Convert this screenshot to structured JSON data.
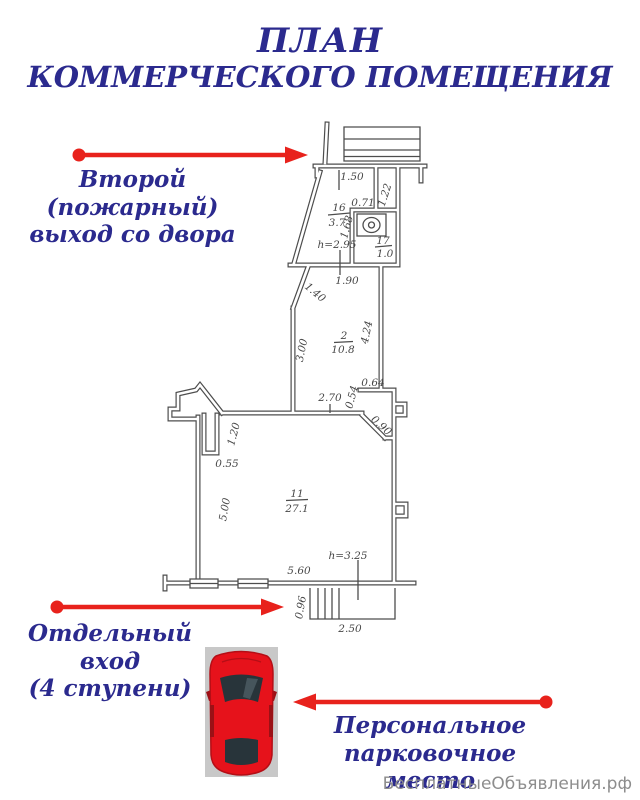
{
  "title": {
    "line1": "ПЛАН",
    "line2": "КОММЕРЧЕСКОГО ПОМЕЩЕНИЯ"
  },
  "annotations": {
    "fire_exit_line1": "Второй (пожарный)",
    "fire_exit_line2": "выход со двора",
    "entrance_line1": "Отдельный вход",
    "entrance_line2": "(4 ступени)",
    "parking_line1": "Персональное",
    "parking_line2": "парковочное место"
  },
  "watermark": "БесплатныеОбъявления.рф",
  "plan": {
    "rooms": {
      "r16": {
        "num": "16",
        "area": "3.7"
      },
      "r17": {
        "num": "17",
        "area": "1.0"
      },
      "r2": {
        "num": "2",
        "area": "10.8"
      },
      "r11": {
        "num": "11",
        "area": "27.1"
      }
    },
    "dims": {
      "d150": "1.50",
      "d122": "1.22",
      "d071": "0.71",
      "d168": "1.68",
      "h295": "h=2.95",
      "d190": "1.90",
      "d140": "1.40",
      "d300": "3.00",
      "d424": "4.24",
      "d270": "2.70",
      "d064": "0.64",
      "d054": "0.54",
      "d090": "0.90",
      "d120": "1.20",
      "d055": "0.55",
      "d500": "5.00",
      "d560": "5.60",
      "h325": "h=3.25",
      "d096": "0.96",
      "d250": "2.50"
    }
  },
  "colors": {
    "heading_blue": "#2b2a8e",
    "arrow_red": "#e8221c",
    "plan_line": "#4d4d4d",
    "car_red": "#e6121b",
    "car_glass": "#28343a",
    "car_bg": "#c8c8c8",
    "watermark_gray": "#8d8d8d"
  }
}
